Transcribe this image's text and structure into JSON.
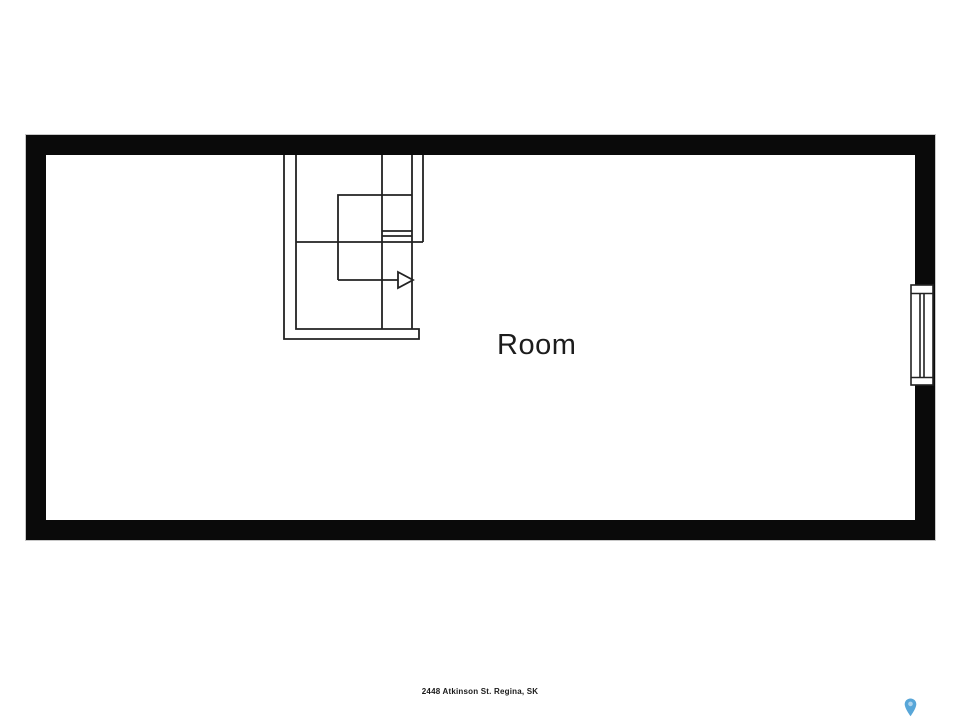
{
  "floor_plan": {
    "room_label": "Room",
    "address_caption": "2448 Atkinson St. Regina, SK",
    "colors": {
      "wall": "#0a0a0a",
      "plan_line": "#222222",
      "outer_outline": "#c8c8c8",
      "pin_blue": "#58a6d8",
      "pin_inner": "#aed4ee",
      "background": "#ffffff"
    },
    "icons": {
      "stair_arrow": "stair-direction-arrow-icon",
      "window": "window-symbol",
      "pin": "location-pin-icon"
    }
  }
}
